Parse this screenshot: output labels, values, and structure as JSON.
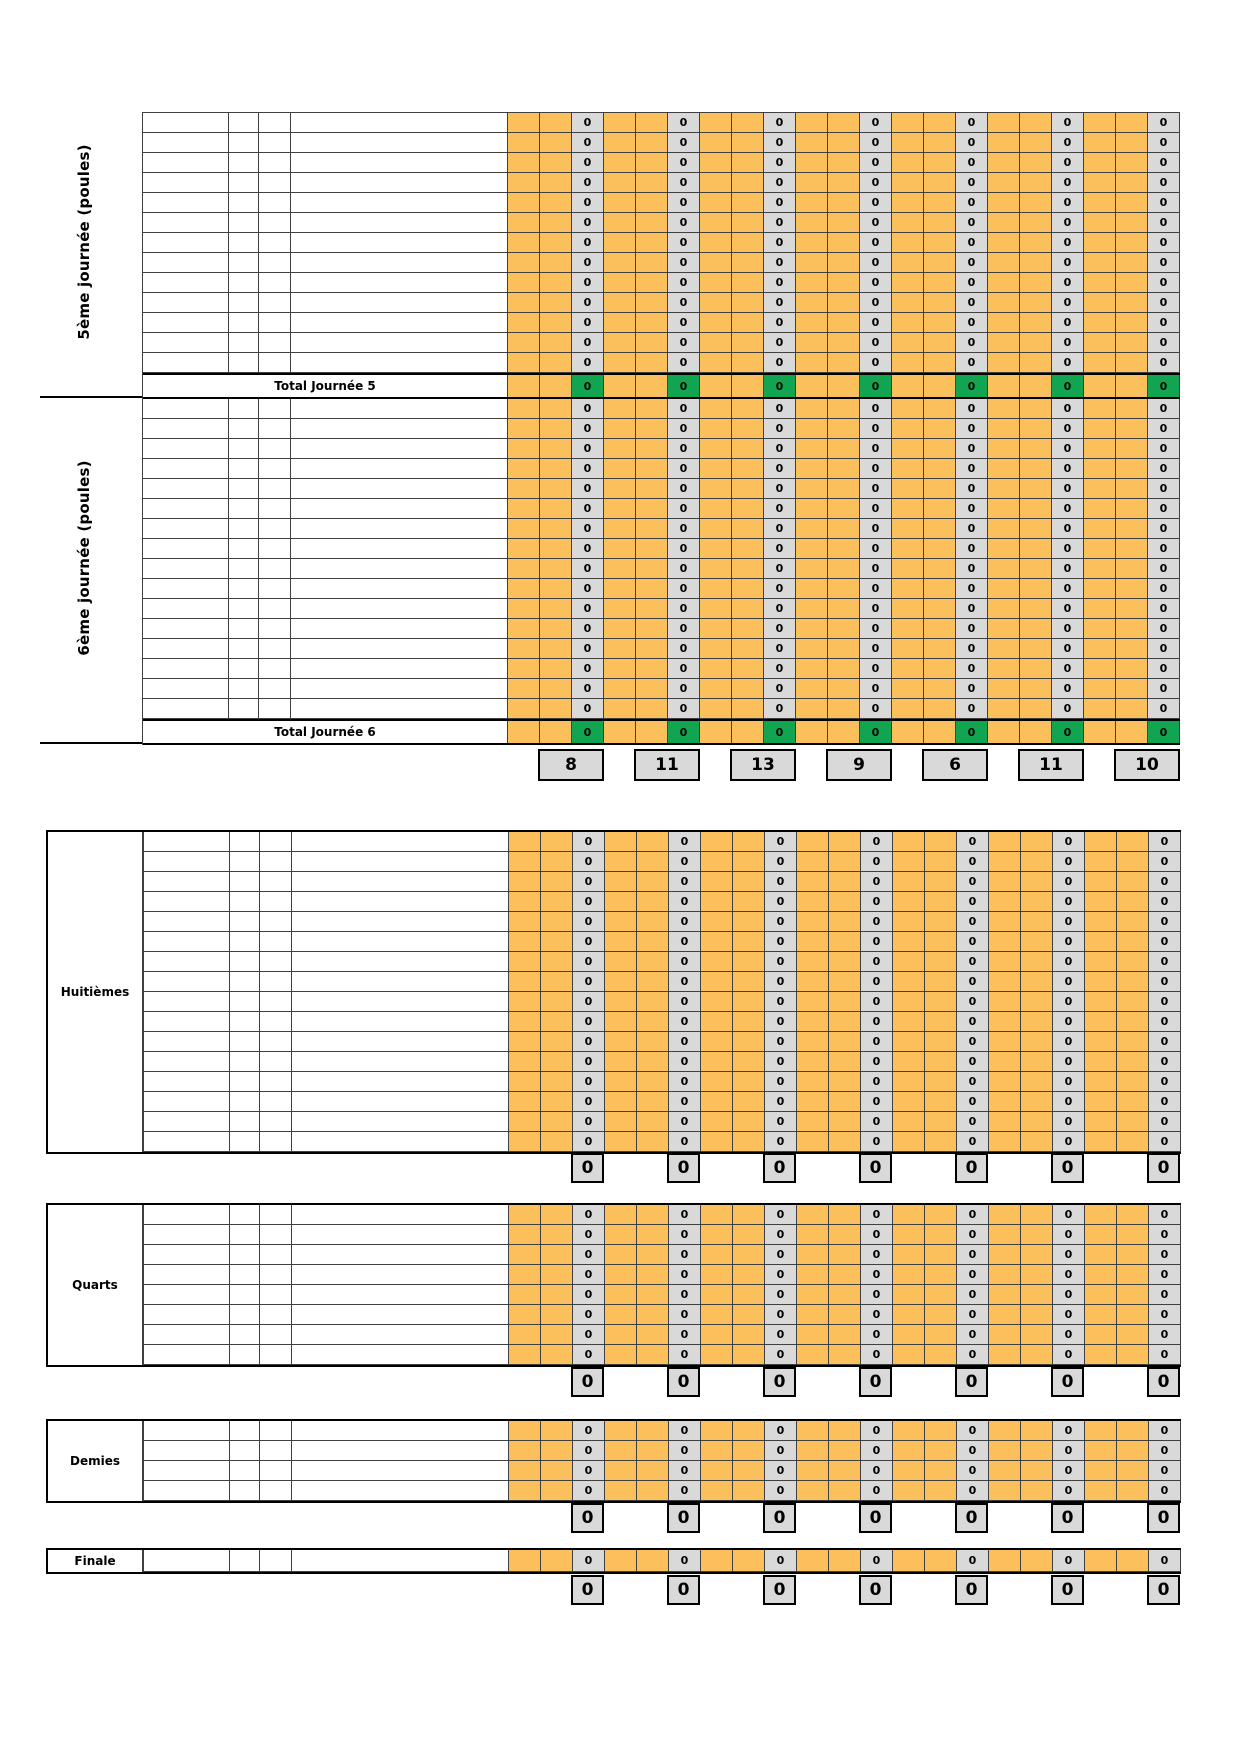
{
  "cell_zero": "0",
  "colors": {
    "orange": "#FBC05C",
    "cell_gray": "#D9D9D9",
    "total_green": "#12A551",
    "grid_line": "#3F3F3F",
    "border_black": "#000000"
  },
  "pool_sections": [
    {
      "label": "5ème journée (poules)",
      "rows": 13,
      "total_label": "Total Journée 5",
      "total_values": [
        "0",
        "0",
        "0",
        "0",
        "0",
        "0",
        "0"
      ]
    },
    {
      "label": "6ème journée (poules)",
      "rows": 16,
      "total_label": "Total Journée 6",
      "total_values": [
        "0",
        "0",
        "0",
        "0",
        "0",
        "0",
        "0"
      ]
    }
  ],
  "grand_totals": [
    "8",
    "11",
    "13",
    "9",
    "6",
    "11",
    "10"
  ],
  "knockout_sections": [
    {
      "label": "Huitièmes",
      "rows": 16,
      "totals": [
        "0",
        "0",
        "0",
        "0",
        "0",
        "0",
        "0"
      ]
    },
    {
      "label": "Quarts",
      "rows": 8,
      "totals": [
        "0",
        "0",
        "0",
        "0",
        "0",
        "0",
        "0"
      ]
    },
    {
      "label": "Demies",
      "rows": 4,
      "totals": [
        "0",
        "0",
        "0",
        "0",
        "0",
        "0",
        "0"
      ]
    },
    {
      "label": "Finale",
      "rows": 1,
      "totals": [
        "0",
        "0",
        "0",
        "0",
        "0",
        "0",
        "0"
      ]
    }
  ]
}
